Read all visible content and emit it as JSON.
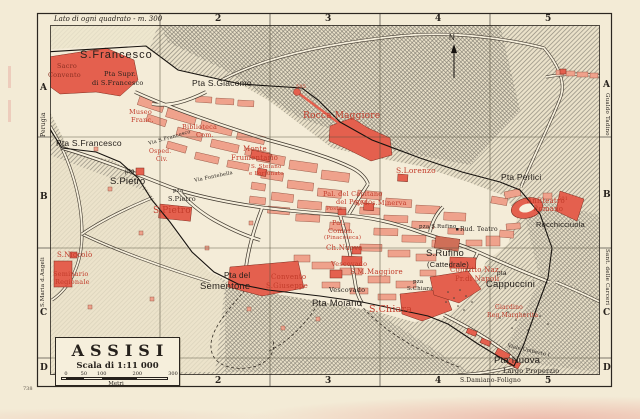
{
  "map": {
    "note": "Lato di ogni quadrato - m. 300",
    "plate_number": "738",
    "grid": {
      "top": [
        {
          "t": "2",
          "x": 215
        },
        {
          "t": "3",
          "x": 325
        },
        {
          "t": "4",
          "x": 435
        },
        {
          "t": "5",
          "x": 545
        }
      ],
      "bottom": [
        {
          "t": "1",
          "x": 105
        },
        {
          "t": "2",
          "x": 215
        },
        {
          "t": "3",
          "x": 325
        },
        {
          "t": "4",
          "x": 435
        },
        {
          "t": "5",
          "x": 545
        }
      ],
      "left": [
        {
          "t": "A",
          "y": 83
        },
        {
          "t": "B",
          "y": 192
        },
        {
          "t": "C",
          "y": 308
        },
        {
          "t": "D",
          "y": 363
        }
      ],
      "right": [
        {
          "t": "A",
          "y": 80
        },
        {
          "t": "B",
          "y": 190
        },
        {
          "t": "C",
          "y": 308
        },
        {
          "t": "D",
          "y": 363
        }
      ]
    },
    "labels": [
      {
        "t": "S.Francesco",
        "x": 80,
        "y": 50,
        "s": 11,
        "c": "black",
        "f": "sans",
        "sp": 1
      },
      {
        "t": "Sacro",
        "x": 57,
        "y": 63,
        "s": 6.5,
        "c": "darkred"
      },
      {
        "t": "Convento",
        "x": 48,
        "y": 72,
        "s": 6.5,
        "c": "darkred"
      },
      {
        "t": "Pta Supr.",
        "x": 104,
        "y": 71,
        "s": 6.5,
        "c": "black"
      },
      {
        "t": "di S.Francesco",
        "x": 92,
        "y": 80,
        "s": 6.5,
        "c": "black"
      },
      {
        "t": "Pta S.Giacomo",
        "x": 192,
        "y": 79,
        "s": 8.5,
        "c": "black",
        "f": "sans"
      },
      {
        "t": "505",
        "x": 296,
        "y": 85,
        "s": 5,
        "c": "red"
      },
      {
        "t": "Rocca Maggiore",
        "x": 303,
        "y": 112,
        "s": 9,
        "c": "red"
      },
      {
        "t": "Museo",
        "x": 129,
        "y": 109,
        "s": 6.5,
        "c": "red"
      },
      {
        "t": "Franc.",
        "x": 131,
        "y": 117,
        "s": 6.5,
        "c": "red"
      },
      {
        "t": "Biblioteca",
        "x": 182,
        "y": 124,
        "s": 6.5,
        "c": "red"
      },
      {
        "t": "Com.",
        "x": 196,
        "y": 132,
        "s": 6.5,
        "c": "red"
      },
      {
        "t": "Pta S.Francesco",
        "x": 56,
        "y": 139,
        "s": 8.5,
        "c": "black",
        "f": "sans"
      },
      {
        "t": "Via S.Francesco",
        "x": 148,
        "y": 142,
        "s": 5,
        "c": "black",
        "rot": -16
      },
      {
        "t": "Osped.",
        "x": 149,
        "y": 149,
        "s": 6,
        "c": "red"
      },
      {
        "t": "Civ.",
        "x": 156,
        "y": 157,
        "s": 6,
        "c": "red"
      },
      {
        "t": "Monte",
        "x": 243,
        "y": 146,
        "s": 7,
        "c": "red"
      },
      {
        "t": "Frumentario",
        "x": 231,
        "y": 155,
        "s": 7,
        "c": "red"
      },
      {
        "t": "S. Stefano",
        "x": 251,
        "y": 165,
        "s": 5.5,
        "c": "red"
      },
      {
        "t": "e Fortunato",
        "x": 249,
        "y": 172,
        "s": 5.5,
        "c": "red"
      },
      {
        "t": "pta",
        "x": 125,
        "y": 169,
        "s": 6.5,
        "c": "black",
        "f": "sans"
      },
      {
        "t": "S.Pietro",
        "x": 110,
        "y": 177,
        "s": 9.5,
        "c": "black",
        "f": "sans"
      },
      {
        "t": "S.Lorenzo",
        "x": 396,
        "y": 167,
        "s": 7.5,
        "c": "red"
      },
      {
        "t": "Pta Perlici",
        "x": 501,
        "y": 173,
        "s": 8.5,
        "c": "black",
        "f": "sans"
      },
      {
        "t": "Via Fontebella",
        "x": 194,
        "y": 179,
        "s": 5,
        "c": "black",
        "rot": -12
      },
      {
        "t": "pza",
        "x": 173,
        "y": 189,
        "s": 5.5,
        "c": "black"
      },
      {
        "t": "S.Pietro",
        "x": 168,
        "y": 196,
        "s": 6.5,
        "c": "black"
      },
      {
        "t": "Pal. del Capitano",
        "x": 323,
        "y": 191,
        "s": 6.5,
        "c": "red"
      },
      {
        "t": "del Popolo",
        "x": 336,
        "y": 199,
        "s": 6.5,
        "c": "red"
      },
      {
        "t": "Posta",
        "x": 326,
        "y": 207,
        "s": 5.5,
        "c": "red"
      },
      {
        "t": "S.M. s.Minerva",
        "x": 354,
        "y": 200,
        "s": 6.5,
        "c": "red"
      },
      {
        "t": "501",
        "x": 558,
        "y": 197,
        "s": 5,
        "c": "red"
      },
      {
        "t": "Anfiteatro",
        "x": 527,
        "y": 198,
        "s": 7,
        "c": "red"
      },
      {
        "t": "Romano",
        "x": 533,
        "y": 206,
        "s": 7,
        "c": "red"
      },
      {
        "t": "S.Pietro",
        "x": 153,
        "y": 207,
        "s": 9,
        "c": "red"
      },
      {
        "t": "Rocchicciuola",
        "x": 536,
        "y": 221,
        "s": 7.5,
        "c": "black",
        "f": "sans"
      },
      {
        "t": "Pal.",
        "x": 332,
        "y": 220,
        "s": 6.5,
        "c": "red"
      },
      {
        "t": "Comun.",
        "x": 328,
        "y": 228,
        "s": 6.5,
        "c": "red"
      },
      {
        "t": "(Pinacoteca)",
        "x": 324,
        "y": 236,
        "s": 5.5,
        "c": "red"
      },
      {
        "t": "pza S.Rufino",
        "x": 419,
        "y": 225,
        "s": 5.5,
        "c": "black"
      },
      {
        "t": "Rud. Teatro",
        "x": 460,
        "y": 227,
        "s": 6,
        "c": "black"
      },
      {
        "t": "Ch.Nuova",
        "x": 326,
        "y": 245,
        "s": 7,
        "c": "red"
      },
      {
        "t": "S.Rufino",
        "x": 426,
        "y": 249,
        "s": 9.5,
        "c": "black",
        "f": "sans"
      },
      {
        "t": "(Cattedrale)",
        "x": 427,
        "y": 261,
        "s": 7.5,
        "c": "black",
        "f": "sans"
      },
      {
        "t": "S.Niccolò",
        "x": 57,
        "y": 252,
        "s": 7,
        "c": "red"
      },
      {
        "t": "Vescovado",
        "x": 331,
        "y": 261,
        "s": 6.5,
        "c": "red"
      },
      {
        "t": "Convitto Naz.",
        "x": 450,
        "y": 267,
        "s": 7,
        "c": "red"
      },
      {
        "t": "Pr.di Napoli",
        "x": 455,
        "y": 276,
        "s": 7,
        "c": "red"
      },
      {
        "t": "S.M.Maggiore",
        "x": 350,
        "y": 269,
        "s": 7,
        "c": "red"
      },
      {
        "t": "pta",
        "x": 497,
        "y": 271,
        "s": 6.5,
        "c": "black",
        "f": "sans"
      },
      {
        "t": "Cappuccini",
        "x": 486,
        "y": 280,
        "s": 9.5,
        "c": "black",
        "f": "sans"
      },
      {
        "t": "Seminario",
        "x": 53,
        "y": 271,
        "s": 6.5,
        "c": "red"
      },
      {
        "t": "Regionale",
        "x": 55,
        "y": 279,
        "s": 6.5,
        "c": "red"
      },
      {
        "t": "Convento",
        "x": 271,
        "y": 274,
        "s": 7,
        "c": "red"
      },
      {
        "t": "S.Giuseppe",
        "x": 266,
        "y": 283,
        "s": 7,
        "c": "red"
      },
      {
        "t": "Pta del",
        "x": 224,
        "y": 272,
        "s": 8,
        "c": "black",
        "f": "sans"
      },
      {
        "t": "Sementone",
        "x": 200,
        "y": 282,
        "s": 9.5,
        "c": "black",
        "f": "sans"
      },
      {
        "t": "Vescovado",
        "x": 329,
        "y": 287,
        "s": 6.5,
        "c": "black"
      },
      {
        "t": "pza",
        "x": 413,
        "y": 280,
        "s": 5.5,
        "c": "black"
      },
      {
        "t": "S.Chiara",
        "x": 407,
        "y": 287,
        "s": 5.5,
        "c": "black"
      },
      {
        "t": "Pta Moiano",
        "x": 312,
        "y": 299,
        "s": 9.5,
        "c": "black",
        "f": "sans"
      },
      {
        "t": "S.Chiara",
        "x": 369,
        "y": 305,
        "s": 9.5,
        "c": "red"
      },
      {
        "t": "Giardino",
        "x": 495,
        "y": 305,
        "s": 6,
        "c": "red"
      },
      {
        "t": "Reg.Margherita",
        "x": 487,
        "y": 313,
        "s": 6,
        "c": "red"
      },
      {
        "t": "Viale Umberto I",
        "x": 508,
        "y": 344,
        "s": 5,
        "c": "black",
        "rot": 13
      },
      {
        "t": "Pta Nuova",
        "x": 494,
        "y": 356,
        "s": 9.5,
        "c": "black",
        "f": "sans"
      },
      {
        "t": "Largo Properzio",
        "x": 503,
        "y": 368,
        "s": 6.5,
        "c": "black"
      },
      {
        "t": "N",
        "x": 449,
        "y": 34,
        "s": 8,
        "c": "black",
        "f": "sans"
      },
      {
        "t": "Perugia",
        "x": 41,
        "y": 137,
        "s": 6,
        "c": "black",
        "rot": -90
      },
      {
        "t": "S.Maria d.Angeli",
        "x": 41,
        "y": 307,
        "s": 5.5,
        "c": "black",
        "rot": -90
      },
      {
        "t": "Gualdo Tadino",
        "x": 609,
        "y": 93,
        "s": 5.5,
        "c": "black",
        "rot": 90
      },
      {
        "t": "Sant. delle Carceri",
        "x": 609,
        "y": 249,
        "s": 5.5,
        "c": "black",
        "rot": 90
      },
      {
        "t": "S.Damiano-Foligno",
        "x": 460,
        "y": 378,
        "s": 6,
        "c": "black"
      }
    ]
  },
  "title_box": {
    "title": "ASSISI",
    "scale_text": "Scala di 1:11 000",
    "unit": "Metri",
    "ticks": [
      {
        "t": "0",
        "m": 0
      },
      {
        "t": "50",
        "m": 50
      },
      {
        "t": "100",
        "m": 100
      },
      {
        "t": "200",
        "m": 200
      },
      {
        "t": "300",
        "m": 300
      }
    ]
  },
  "colors": {
    "paper": "#f3ebd6",
    "landmark_red": "#e4604e",
    "block_salmon": "#efa28c",
    "label_red": "#c23b2a",
    "ink": "#26211c"
  }
}
